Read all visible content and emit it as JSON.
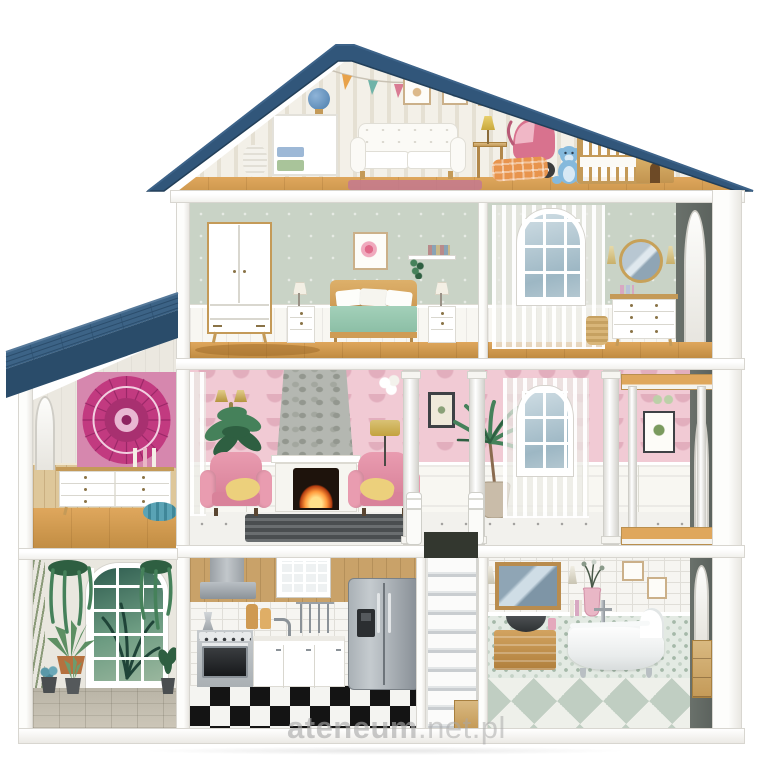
{
  "watermark": {
    "brand": "ateneum",
    "suffix": ".net.pl"
  },
  "palette": {
    "roof": "#31567a",
    "roof_edge": "#223f59",
    "shingle": "#3c6386",
    "shingle_line": "#2b4d6c",
    "fascia": "#2a4c6a",
    "wall": "#ffffff",
    "wall_edge": "#d8d6d0",
    "slab_face": "#f2f1ed",
    "stripe_a": "#f3f0e8",
    "stripe_b": "#e5e0d3",
    "wood": "#dfa75d",
    "wood_dark": "#c08c42",
    "wood_trim": "#c49a58",
    "sage": "#c9d3c6",
    "pink": "#f1cad4",
    "pink_pat": "#e2aebd",
    "wainscot": "#f8f7f2",
    "panel_line": "#dcdbd2",
    "kitchen_wood": "#c9a269",
    "tile": "#f6f5f1",
    "grout": "#e0ded8",
    "fridge_a": "#aab1b6",
    "fridge_b": "#868d94",
    "checker_dark": "#141414",
    "checker_light": "#f4f4f1",
    "mosaic_bg": "#e3eae3",
    "mosaic_dot": "#a5b9a9",
    "bath_a": "#eef0ea",
    "bath_b": "#c0cec2",
    "mandala": "#c23a80",
    "mandala_dark": "#8e2360",
    "mandala_bg": "#d687ae",
    "plant": "#45815a",
    "plant_dark": "#2e5f41",
    "terracotta": "#b5713f",
    "pram": "#d8728e",
    "teddy": "#85b9dc",
    "chair": "#e99cb0",
    "chair_dark": "#d9829a",
    "blanket": "#a3d0b9",
    "throw": "#ecd07c",
    "stone": "#b4b7b1",
    "stone_dot": "#93978f",
    "stonefloor": "#ccc6b8",
    "gold": "#c3a23f",
    "dark_wall": "#5c635e",
    "fire_core": "#ffe08a",
    "fire_mid": "#ff9a3c",
    "rug_dark": "#4a4e50",
    "rug_pink": "#c4798f",
    "watermark": "#a9a9a9"
  }
}
